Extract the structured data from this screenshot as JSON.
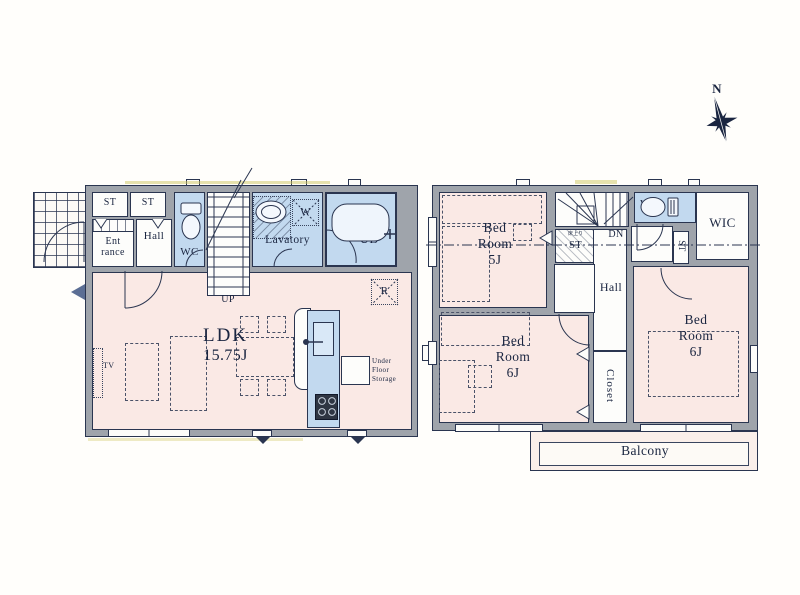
{
  "palette": {
    "wall": "#9FA4AB",
    "line": "#2A3550",
    "room_pink": "#FAE9E5",
    "room_blue": "#C2D9EF",
    "room_white": "#FDFDFB",
    "paper": "#FFFEFB"
  },
  "compass": {
    "north": "N"
  },
  "f1": {
    "st_left": "ST",
    "st_right": "ST",
    "entrance_l1": "Ent",
    "entrance_l2": "rance",
    "hall": "Hall",
    "wc": "WC",
    "up": "UP",
    "lavatory": "Lavatory",
    "washer": "W",
    "bath": "UB",
    "ldk_l1": "LDK",
    "ldk_l2": "15.75J",
    "tv": "TV",
    "fridge": "R",
    "ufs_l1": "Under",
    "ufs_l2": "Floor",
    "ufs_l3": "Storage"
  },
  "f2": {
    "bed5_l1": "Bed",
    "bed5_l2": "Room",
    "bed5_l3": "5J",
    "dn": "DN",
    "st_small_note": "床上り",
    "st_small": "ST",
    "wc": "WC",
    "wic": "WIC",
    "st_side": "ST",
    "hall": "Hall",
    "closet": "Closet",
    "bed6a_l1": "Bed",
    "bed6a_l2": "Room",
    "bed6a_l3": "6J",
    "bed6b_l1": "Bed",
    "bed6b_l2": "Room",
    "bed6b_l3": "6J",
    "balcony": "Balcony"
  }
}
